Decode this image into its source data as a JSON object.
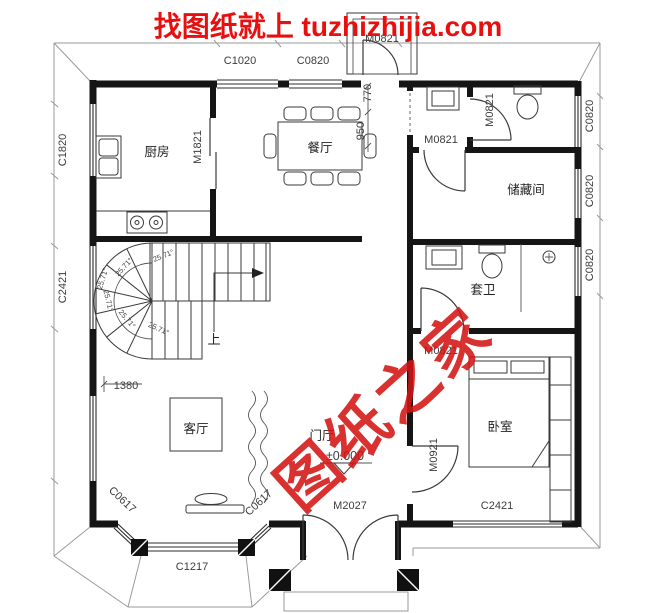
{
  "title": "找图纸就上 tuzhizhijia.com",
  "watermark": "图纸之家",
  "rooms": {
    "kitchen": "厨房",
    "dining": "餐厅",
    "storage": "储藏间",
    "ensuite": "套卫",
    "bedroom": "卧室",
    "living": "客厅",
    "foyer": "门厅"
  },
  "doors": {
    "balcony": "M0821",
    "wc": "M0821",
    "lobby": "M0821",
    "ensuite": "M0821",
    "kitchen": "M1821",
    "bedroom": "M0921",
    "entry": "M2027"
  },
  "windows": {
    "top1": "C1020",
    "top2": "C0820",
    "left1": "C1820",
    "left2": "C2421",
    "right1": "C0820",
    "right2": "C0820",
    "right3": "C0820",
    "bay_left": "C0617",
    "bay_front": "C1217",
    "bay_right": "C0617",
    "bedroom": "C2421"
  },
  "dims": {
    "w770": "770",
    "w950": "950",
    "w1380": "1380",
    "level": "±0.000",
    "angle": "25.71°",
    "up": "上"
  },
  "colors": {
    "accent": "#e80f0f",
    "wall": "#151515",
    "outline": "#9a9a9a"
  }
}
